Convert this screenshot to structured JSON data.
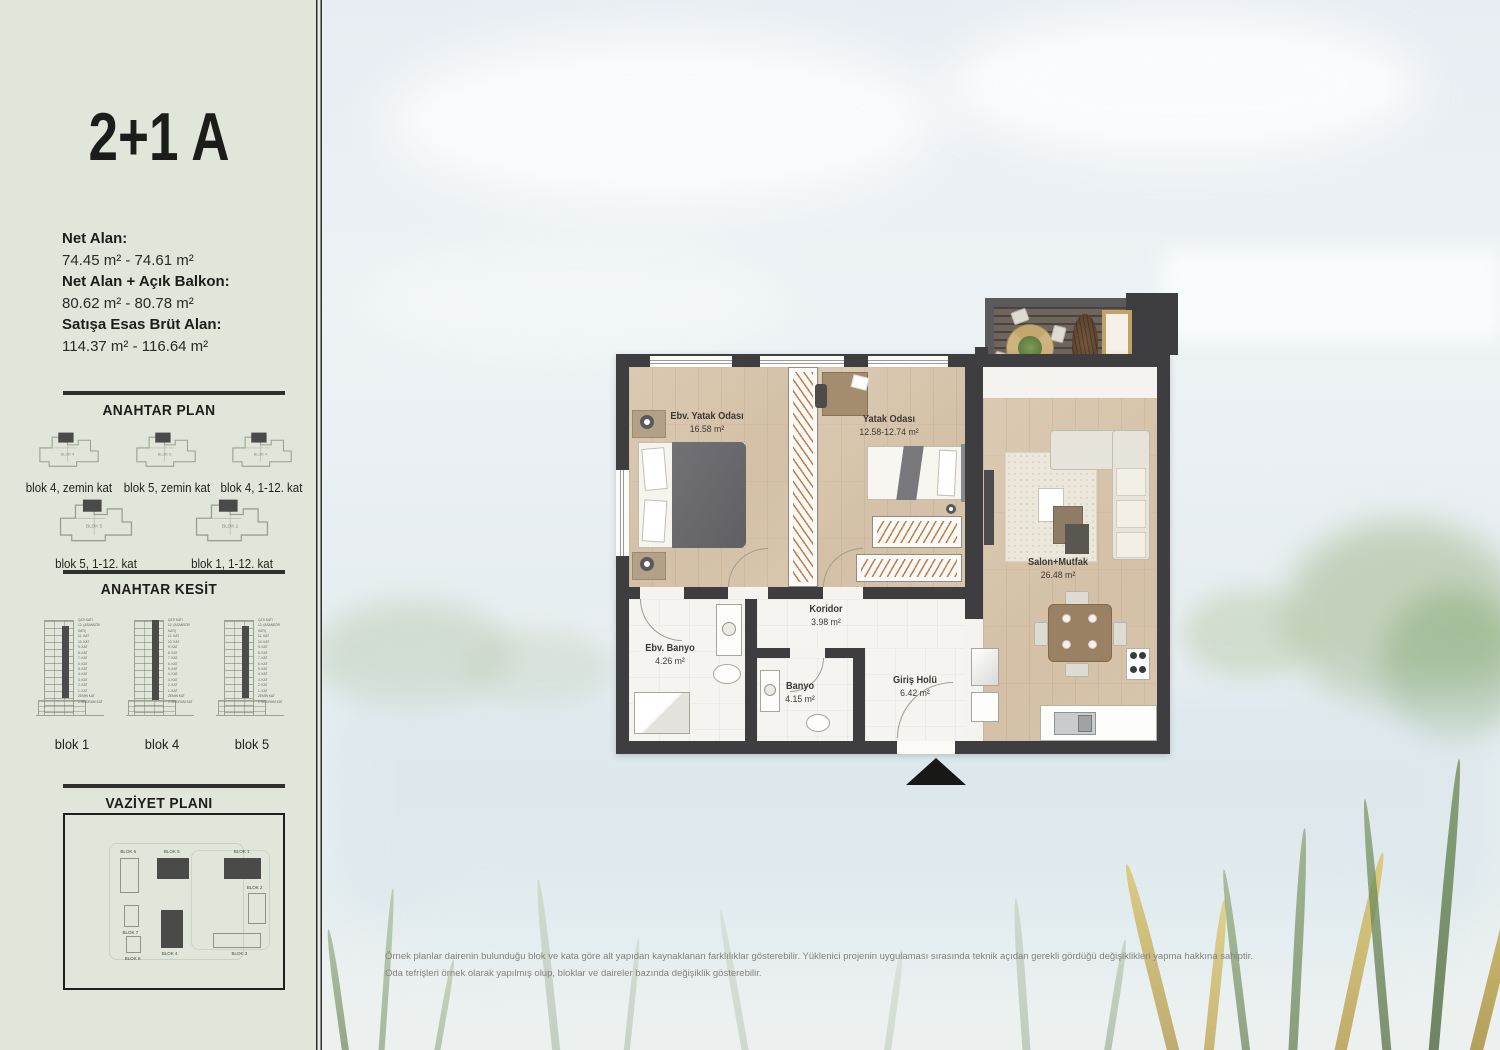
{
  "sidebar": {
    "title": "2+1 A",
    "areas": [
      {
        "label": "Net Alan:",
        "value": "74.45 m² - 74.61 m²"
      },
      {
        "label": "Net Alan + Açık Balkon:",
        "value": "80.62 m² - 80.78 m²"
      },
      {
        "label": "Satışa Esas Brüt Alan:",
        "value": "114.37 m² - 116.64 m²"
      }
    ],
    "anahtar_plan": {
      "heading": "ANAHTAR PLAN",
      "items": [
        {
          "tag": "BLOK 4",
          "label": "blok 4, zemin kat"
        },
        {
          "tag": "BLOK 5",
          "label": "blok 5, zemin kat"
        },
        {
          "tag": "BLOK 4",
          "label": "blok 4, 1-12. kat"
        },
        {
          "tag": "BLOK 5",
          "label": "blok 5, 1-12. kat"
        },
        {
          "tag": "BLOK 1",
          "label": "blok 1, 1-12. kat"
        }
      ]
    },
    "anahtar_kesit": {
      "heading": "ANAHTAR KESİT",
      "floor_labels": "ÇATI KATI\n12. (ASANSÖR KATI)\n11. KAT\n10. KAT\n9. KAT\n8. KAT\n7. KAT\n6. KAT\n5. KAT\n4. KAT\n3. KAT\n2. KAT\n1. KAT\nZEMİN KAT\n1. BODRUM KAT",
      "items": [
        {
          "label": "blok 1"
        },
        {
          "label": "blok 4"
        },
        {
          "label": "blok 5"
        }
      ]
    },
    "vaziyet_plani": {
      "heading": "VAZİYET PLANI",
      "blocks": [
        "BLOK 6",
        "BLOK 5",
        "BLOK 1",
        "BLOK 2",
        "BLOK 7",
        "BLOK 8",
        "BLOK 4",
        "BLOK 3"
      ]
    }
  },
  "floorplan": {
    "rooms": [
      {
        "name": "Ebv. Yatak Odası",
        "area": "16.58 m²"
      },
      {
        "name": "Yatak Odası",
        "area": "12.58-12.74 m²"
      },
      {
        "name": "Salon+Mutfak",
        "area": "26.48 m²"
      },
      {
        "name": "Balkon",
        "area": "6.17 m²"
      },
      {
        "name": "Koridor",
        "area": "3.98 m²"
      },
      {
        "name": "Ebv. Banyo",
        "area": "4.26 m²"
      },
      {
        "name": "Banyo",
        "area": "4.15 m²"
      },
      {
        "name": "Giriş Holü",
        "area": "6.42 m²"
      }
    ]
  },
  "footer": {
    "line1": "Örnek planlar dairenin bulunduğu blok ve kata göre alt yapıdan kaynaklanan farklılıklar gösterebilir. Yüklenici projenin uygulaması sırasında teknik açıdan gerekli gördüğü değişiklikleri yapma hakkına sahiptir.",
    "line2": "Oda tefrişleri örnek olarak yapılmış olup, bloklar ve daireler bazında değişiklik gösterebilir."
  },
  "colors": {
    "sidebar_bg": "#e0e6da",
    "divider": "#2f2f2d",
    "wall": "#3e3e41",
    "wood_floor": "#d6c4ab",
    "tile_floor": "#f5f4f0",
    "balcony_deck": "#6e655c",
    "wardrobe_accent": "#ba703a",
    "title_text": "#1c1c1a",
    "muted_text": "#82827d",
    "plan_label_light": "#f3f0e9"
  }
}
